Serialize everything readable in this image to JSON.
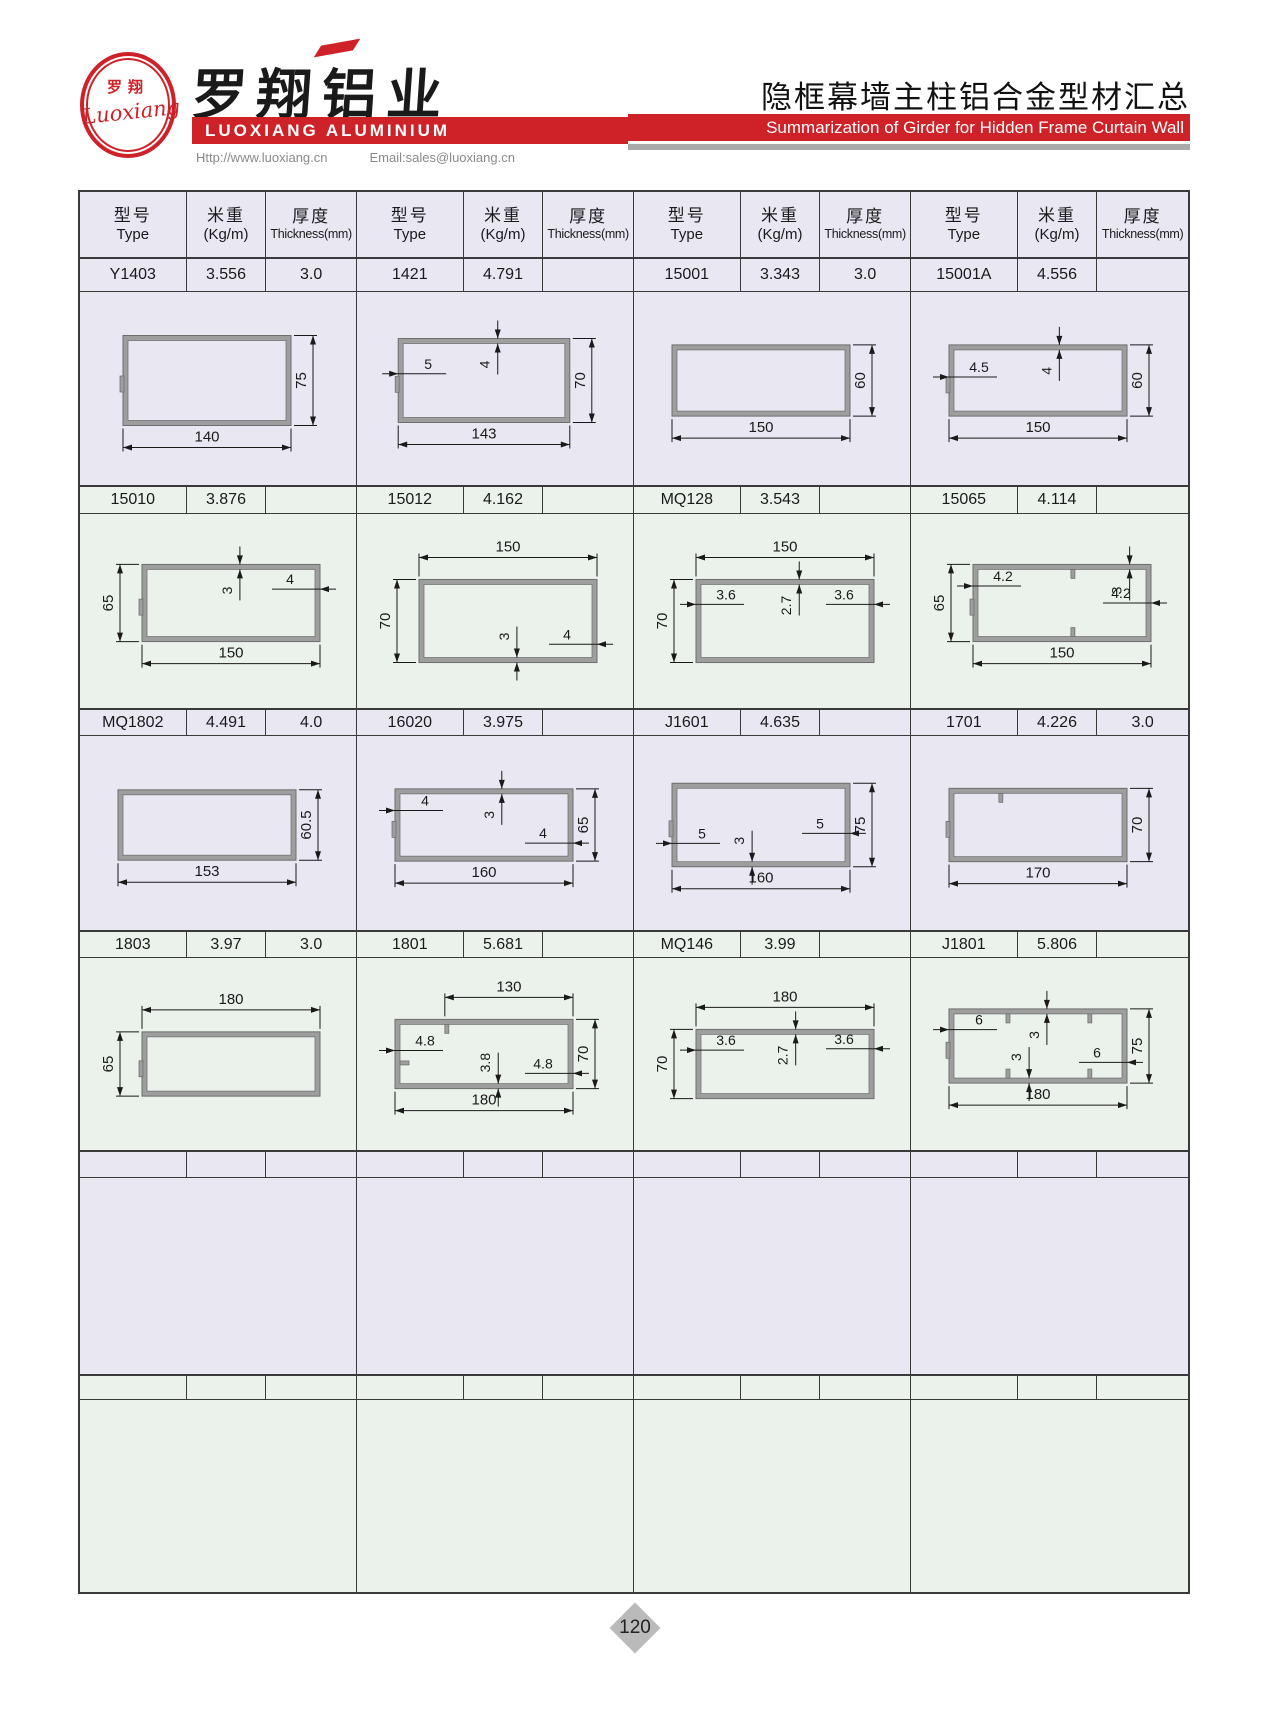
{
  "page": {
    "number": "120"
  },
  "colors": {
    "accent_red": "#cf2128",
    "tint_lavender": "#e8e7f2",
    "tint_green": "#ebf2ec",
    "profile_wall": "#9e9e9e",
    "profile_edge": "#6e6e6e",
    "diamond_gray": "#bababa"
  },
  "header": {
    "logo": {
      "zh": "罗翔",
      "script": "Luoxiang"
    },
    "company_zh": "罗翔铝业",
    "company_en": "LUOXIANG ALUMINIUM",
    "website": "Http://www.luoxiang.cn",
    "email": "Email:sales@luoxiang.cn",
    "title_zh": "隐框幕墙主柱铝合金型材汇总",
    "title_en": "Summarization of Girder for Hidden Frame Curtain Wall"
  },
  "table": {
    "columns": [
      {
        "zh": "型号",
        "en": "Type"
      },
      {
        "zh": "米重",
        "en": "(Kg/m)"
      },
      {
        "zh": "厚度",
        "en": "Thickness(mm)"
      }
    ],
    "groups": 4,
    "data_row_heights": [
      35,
      29,
      28,
      28,
      28,
      26
    ],
    "diagram_row_heights": [
      193,
      194,
      194,
      192,
      196,
      192
    ],
    "rows": [
      {
        "tint": "lavender",
        "entries": [
          {
            "type": "Y1403",
            "kgm": "3.556",
            "thickness": "3.0",
            "diagram": {
              "w": 140,
              "h": 75,
              "wd": {
                "l": "140",
                "s": "bottom"
              },
              "hd": {
                "l": "75",
                "s": "right"
              },
              "notch": true
            }
          },
          {
            "type": "1421",
            "kgm": "4.791",
            "thickness": "",
            "diagram": {
              "w": 143,
              "h": 70,
              "wd": {
                "l": "143",
                "s": "bottom"
              },
              "hd": {
                "l": "70",
                "s": "right"
              },
              "notch": true,
              "th": [
                {
                  "l": "5",
                  "s": "left",
                  "f": 0.42
                },
                {
                  "l": "4",
                  "s": "top",
                  "f": 0.58
                }
              ]
            }
          },
          {
            "type": "15001",
            "kgm": "3.343",
            "thickness": "3.0",
            "diagram": {
              "w": 150,
              "h": 60,
              "wd": {
                "l": "150",
                "s": "bottom"
              },
              "hd": {
                "l": "60",
                "s": "right"
              }
            }
          },
          {
            "type": "15001A",
            "kgm": "4.556",
            "thickness": "",
            "diagram": {
              "w": 150,
              "h": 60,
              "wd": {
                "l": "150",
                "s": "bottom"
              },
              "hd": {
                "l": "60",
                "s": "right"
              },
              "notch": true,
              "th": [
                {
                  "l": "4.5",
                  "s": "left",
                  "f": 0.45
                },
                {
                  "l": "4",
                  "s": "top",
                  "f": 0.62
                }
              ]
            }
          }
        ]
      },
      {
        "tint": "green",
        "entries": [
          {
            "type": "15010",
            "kgm": "3.876",
            "thickness": "",
            "diagram": {
              "w": 150,
              "h": 65,
              "wd": {
                "l": "150",
                "s": "bottom"
              },
              "hd": {
                "l": "65",
                "s": "left"
              },
              "notch": true,
              "th": [
                {
                  "l": "3",
                  "s": "top",
                  "f": 0.55
                },
                {
                  "l": "4",
                  "s": "right",
                  "f": 0.32
                }
              ]
            }
          },
          {
            "type": "15012",
            "kgm": "4.162",
            "thickness": "",
            "diagram": {
              "w": 150,
              "h": 70,
              "wd": {
                "l": "150",
                "s": "top"
              },
              "hd": {
                "l": "70",
                "s": "left"
              },
              "th": [
                {
                  "l": "3",
                  "s": "bottom",
                  "f": 0.55
                },
                {
                  "l": "4",
                  "s": "right",
                  "f": 0.78
                }
              ]
            }
          },
          {
            "type": "MQ128",
            "kgm": "3.543",
            "thickness": "",
            "diagram": {
              "w": 150,
              "h": 70,
              "wd": {
                "l": "150",
                "s": "top"
              },
              "hd": {
                "l": "70",
                "s": "left"
              },
              "th": [
                {
                  "l": "3.6",
                  "s": "left",
                  "f": 0.3
                },
                {
                  "l": "2.7",
                  "s": "top",
                  "f": 0.58
                },
                {
                  "l": "3.6",
                  "s": "right",
                  "f": 0.3
                }
              ]
            }
          },
          {
            "type": "15065",
            "kgm": "4.114",
            "thickness": "",
            "diagram": {
              "w": 150,
              "h": 65,
              "wd": {
                "l": "150",
                "s": "bottom"
              },
              "hd": {
                "l": "65",
                "s": "left"
              },
              "notch": true,
              "th": [
                {
                  "l": "4.2",
                  "s": "left",
                  "f": 0.28
                },
                {
                  "l": "3",
                  "s": "top",
                  "f": 0.88
                },
                {
                  "l": "4.2",
                  "s": "right",
                  "f": 0.5
                }
              ],
              "ribs": [
                {
                  "w": "top",
                  "f": 0.55
                },
                {
                  "w": "bottom",
                  "f": 0.55
                }
              ]
            }
          }
        ]
      },
      {
        "tint": "lavender",
        "entries": [
          {
            "type": "MQ1802",
            "kgm": "4.491",
            "thickness": "4.0",
            "diagram": {
              "w": 153,
              "h": 60.5,
              "wd": {
                "l": "153",
                "s": "bottom"
              },
              "hd": {
                "l": "60.5",
                "s": "right"
              }
            }
          },
          {
            "type": "16020",
            "kgm": "3.975",
            "thickness": "",
            "diagram": {
              "w": 160,
              "h": 65,
              "wd": {
                "l": "160",
                "s": "bottom"
              },
              "hd": {
                "l": "65",
                "s": "right"
              },
              "notch": true,
              "th": [
                {
                  "l": "4",
                  "s": "left",
                  "f": 0.3
                },
                {
                  "l": "3",
                  "s": "top",
                  "f": 0.6
                },
                {
                  "l": "4",
                  "s": "right",
                  "f": 0.75
                }
              ]
            }
          },
          {
            "type": "J1601",
            "kgm": "4.635",
            "thickness": "",
            "diagram": {
              "w": 160,
              "h": 75,
              "wd": {
                "l": "160",
                "s": "bottom"
              },
              "hd": {
                "l": "75",
                "s": "right"
              },
              "notch": true,
              "th": [
                {
                  "l": "5",
                  "s": "left",
                  "f": 0.72
                },
                {
                  "l": "3",
                  "s": "bottom",
                  "f": 0.45
                },
                {
                  "l": "5",
                  "s": "right",
                  "f": 0.6
                }
              ]
            }
          },
          {
            "type": "1701",
            "kgm": "4.226",
            "thickness": "3.0",
            "diagram": {
              "w": 170,
              "h": 70,
              "wd": {
                "l": "170",
                "s": "bottom"
              },
              "hd": {
                "l": "70",
                "s": "right"
              },
              "notch": true,
              "ribs": [
                {
                  "w": "top",
                  "f": 0.28
                }
              ]
            }
          }
        ]
      },
      {
        "tint": "green",
        "entries": [
          {
            "type": "1803",
            "kgm": "3.97",
            "thickness": "3.0",
            "diagram": {
              "w": 180,
              "h": 65,
              "wd": {
                "l": "180",
                "s": "top"
              },
              "hd": {
                "l": "65",
                "s": "left"
              },
              "notch": true
            }
          },
          {
            "type": "1801",
            "kgm": "5.681",
            "thickness": "",
            "diagram": {
              "w": 180,
              "h": 70,
              "wd": {
                "l": "180",
                "s": "bottom"
              },
              "wd2": {
                "l": "130",
                "s": "top",
                "f": 0.28
              },
              "hd": {
                "l": "70",
                "s": "right"
              },
              "th": [
                {
                  "l": "4.8",
                  "s": "left",
                  "f": 0.45
                },
                {
                  "l": "3.8",
                  "s": "bottom",
                  "f": 0.58
                },
                {
                  "l": "4.8",
                  "s": "right",
                  "f": 0.78
                }
              ],
              "ribs": [
                {
                  "w": "top",
                  "f": 0.28
                },
                {
                  "w": "left",
                  "f": 0.6
                }
              ]
            }
          },
          {
            "type": "MQ146",
            "kgm": "3.99",
            "thickness": "",
            "diagram": {
              "w": 180,
              "h": 70,
              "wd": {
                "l": "180",
                "s": "top"
              },
              "hd": {
                "l": "70",
                "s": "left"
              },
              "th": [
                {
                  "l": "3.6",
                  "s": "left",
                  "f": 0.3
                },
                {
                  "l": "2.7",
                  "s": "top",
                  "f": 0.56
                },
                {
                  "l": "3.6",
                  "s": "right",
                  "f": 0.28
                }
              ]
            }
          },
          {
            "type": "J1801",
            "kgm": "5.806",
            "thickness": "",
            "diagram": {
              "w": 180,
              "h": 75,
              "wd": {
                "l": "180",
                "s": "bottom"
              },
              "hd": {
                "l": "75",
                "s": "right"
              },
              "notch": true,
              "th": [
                {
                  "l": "3",
                  "s": "top",
                  "f": 0.55
                },
                {
                  "l": "6",
                  "s": "left",
                  "f": 0.28
                },
                {
                  "l": "3",
                  "s": "bottom",
                  "f": 0.45
                },
                {
                  "l": "6",
                  "s": "right",
                  "f": 0.72
                }
              ],
              "ribs": [
                {
                  "w": "top",
                  "f": 0.32
                },
                {
                  "w": "top",
                  "f": 0.78
                },
                {
                  "w": "bottom",
                  "f": 0.32
                },
                {
                  "w": "bottom",
                  "f": 0.78
                }
              ]
            }
          }
        ]
      },
      {
        "tint": "lavender",
        "entries": [
          {
            "type": "",
            "kgm": "",
            "thickness": "",
            "diagram": null
          },
          {
            "type": "",
            "kgm": "",
            "thickness": "",
            "diagram": null
          },
          {
            "type": "",
            "kgm": "",
            "thickness": "",
            "diagram": null
          },
          {
            "type": "",
            "kgm": "",
            "thickness": "",
            "diagram": null
          }
        ]
      },
      {
        "tint": "green",
        "entries": [
          {
            "type": "",
            "kgm": "",
            "thickness": "",
            "diagram": null
          },
          {
            "type": "",
            "kgm": "",
            "thickness": "",
            "diagram": null
          },
          {
            "type": "",
            "kgm": "",
            "thickness": "",
            "diagram": null
          },
          {
            "type": "",
            "kgm": "",
            "thickness": "",
            "diagram": null
          }
        ]
      }
    ]
  }
}
